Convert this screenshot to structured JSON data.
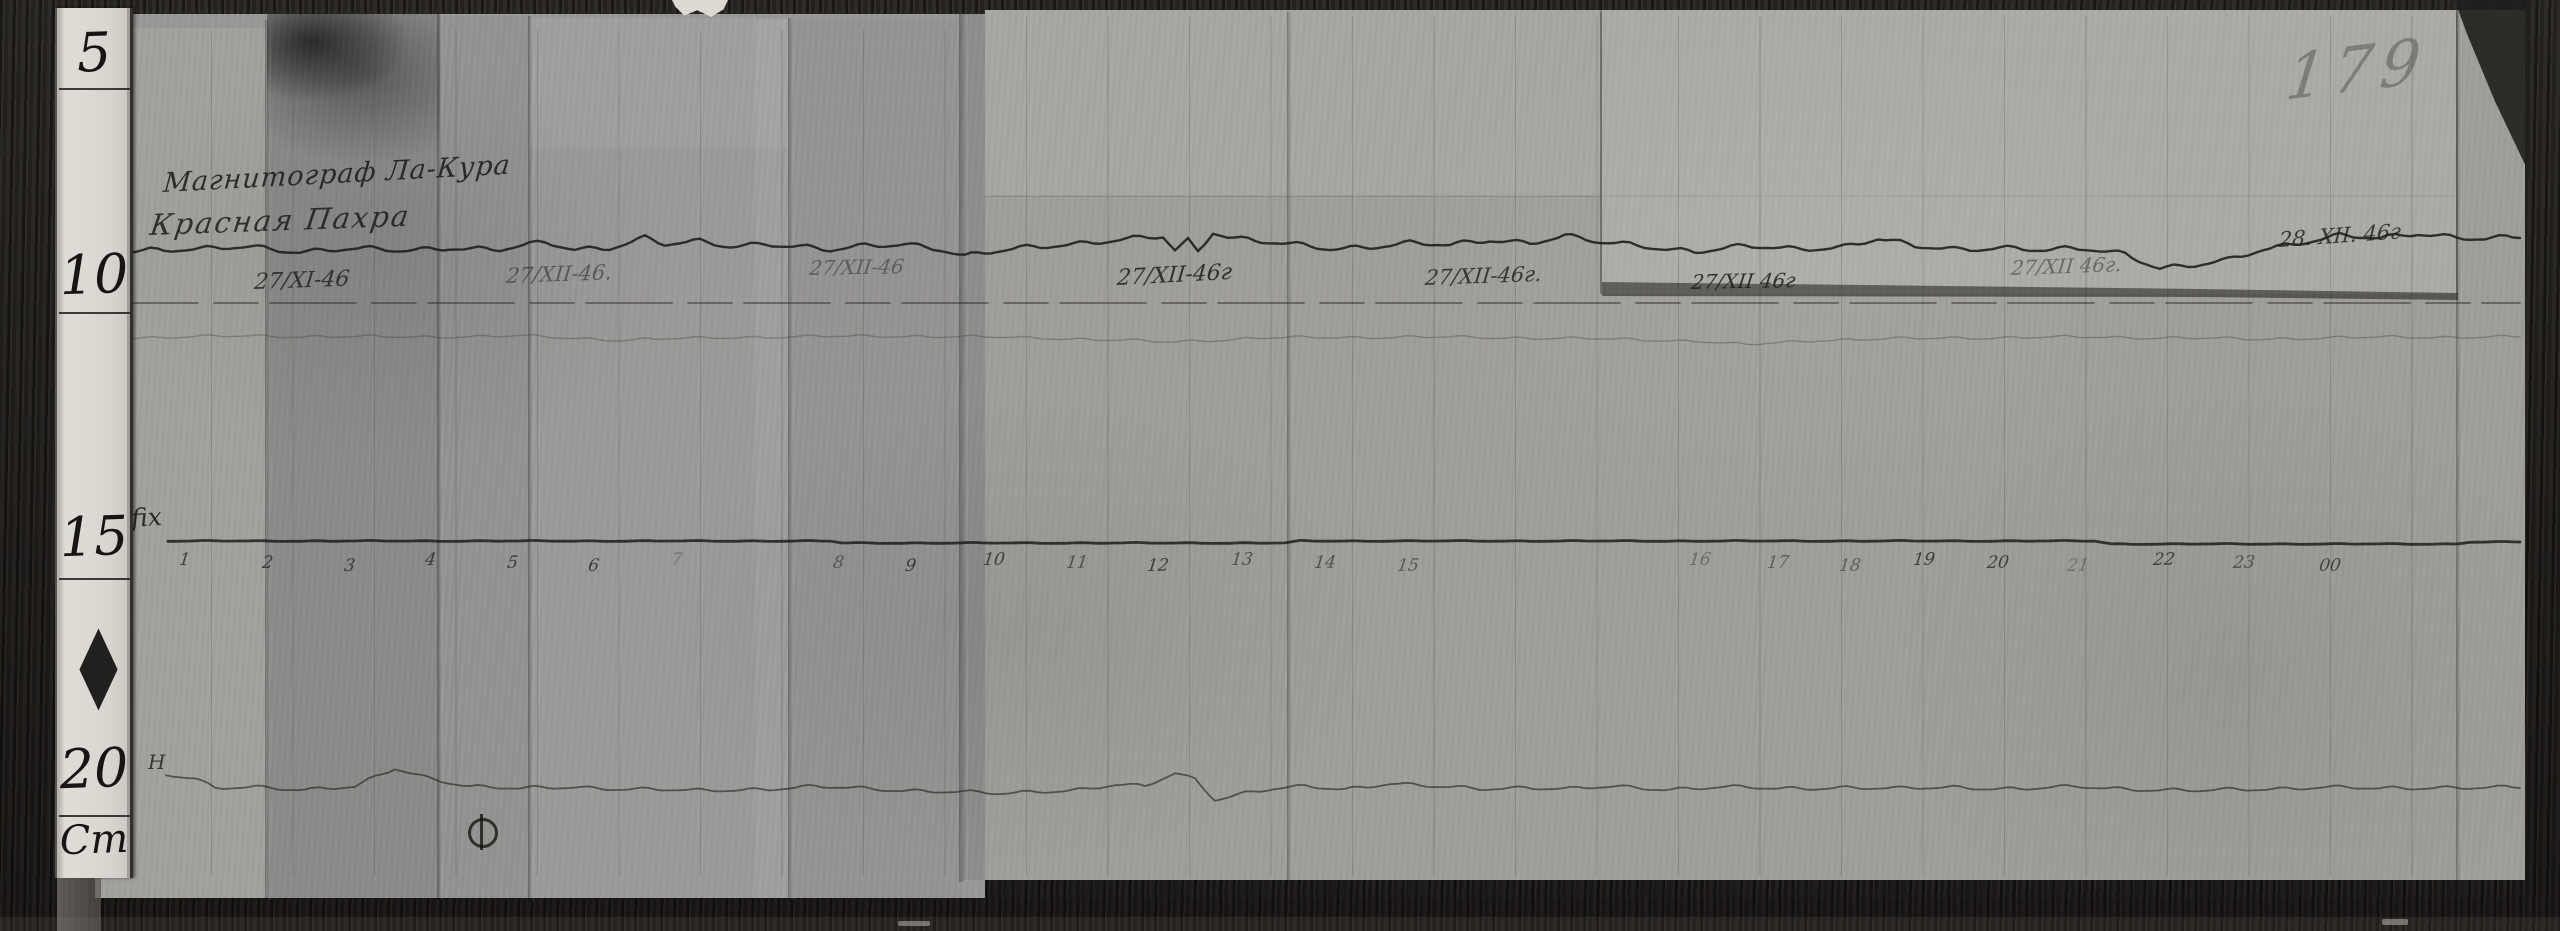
{
  "photo": {
    "page_number": "179",
    "header": {
      "instrument": "Магнитограф Ла-Кура",
      "station": "Красная Пахра"
    },
    "trace_labels": {
      "declination": "D",
      "baseline": "fix",
      "horizontal": "H"
    },
    "ruler": {
      "marks": [
        "5",
        "10",
        "15",
        "20"
      ],
      "unit_label": "Cm"
    },
    "dates": [
      {
        "text": "27/XI-46",
        "x": 253,
        "y": 270,
        "size": 22,
        "opacity": 0.8,
        "rotate": -2
      },
      {
        "text": "27/XII-46.",
        "x": 505,
        "y": 264,
        "size": 21,
        "opacity": 0.5,
        "rotate": -2
      },
      {
        "text": "27/XII-46",
        "x": 808,
        "y": 256,
        "size": 20,
        "opacity": 0.45,
        "rotate": -1
      },
      {
        "text": "27/XII-46г",
        "x": 1116,
        "y": 266,
        "size": 22,
        "opacity": 0.85,
        "rotate": -3
      },
      {
        "text": "27/XII-46г.",
        "x": 1424,
        "y": 266,
        "size": 21,
        "opacity": 0.8,
        "rotate": -2
      },
      {
        "text": "27/XII 46г",
        "x": 1690,
        "y": 270,
        "size": 20,
        "opacity": 0.85,
        "rotate": -1
      },
      {
        "text": "27/XII 46г.",
        "x": 2010,
        "y": 256,
        "size": 20,
        "opacity": 0.45,
        "rotate": -2
      },
      {
        "text": "28. XII. 46г",
        "x": 2278,
        "y": 228,
        "size": 21,
        "opacity": 0.8,
        "rotate": -4
      }
    ],
    "hours": [
      {
        "label": "1",
        "x": 178
      },
      {
        "label": "2",
        "x": 261
      },
      {
        "label": "3",
        "x": 343
      },
      {
        "label": "4",
        "x": 424
      },
      {
        "label": "5",
        "x": 506
      },
      {
        "label": "6",
        "x": 587
      },
      {
        "label": "7",
        "x": 670,
        "opacity": 0.3
      },
      {
        "label": "8",
        "x": 832,
        "opacity": 0.55
      },
      {
        "label": "9",
        "x": 904
      },
      {
        "label": "10",
        "x": 982
      },
      {
        "label": "11",
        "x": 1065,
        "opacity": 0.6
      },
      {
        "label": "12",
        "x": 1146
      },
      {
        "label": "13",
        "x": 1230,
        "opacity": 0.6
      },
      {
        "label": "14",
        "x": 1313,
        "opacity": 0.6
      },
      {
        "label": "15",
        "x": 1396,
        "opacity": 0.55
      },
      {
        "label": "16",
        "x": 1688,
        "opacity": 0.4
      },
      {
        "label": "17",
        "x": 1766,
        "opacity": 0.5
      },
      {
        "label": "18",
        "x": 1838,
        "opacity": 0.5
      },
      {
        "label": "19",
        "x": 1912
      },
      {
        "label": "20",
        "x": 1986
      },
      {
        "label": "21",
        "x": 2066,
        "opacity": 0.35
      },
      {
        "label": "22",
        "x": 2152
      },
      {
        "label": "23",
        "x": 2232,
        "opacity": 0.6
      },
      {
        "label": "00",
        "x": 2318,
        "opacity": 0.7
      }
    ]
  },
  "chart_data": {
    "type": "line",
    "title": "Магнитограф Ла-Кура — Красная Пахра",
    "subtitle_dates": [
      "27/XI-46",
      "27/XII-46.",
      "27/XII-46",
      "27/XII-46г",
      "27/XII-46г.",
      "27/XII 46г",
      "27/XII 46г.",
      "28. XII. 46г"
    ],
    "xlabel": "hours (1–23, 00)",
    "x_ticks": [
      "1",
      "2",
      "3",
      "4",
      "5",
      "6",
      "7",
      "8",
      "9",
      "10",
      "11",
      "12",
      "13",
      "14",
      "15",
      "16",
      "17",
      "18",
      "19",
      "20",
      "21",
      "22",
      "23",
      "00"
    ],
    "ylabel": "",
    "legend": [
      "D (declination trace)",
      "straight reference line",
      "secondary faint trace",
      "fix (time baseline)",
      "H (horizontal-intensity trace)"
    ],
    "note": "Photographic magnetogram; no printed vertical scale. Points are [x_px, y_px] anchors of the traces in image coordinates.",
    "series": [
      {
        "name": "D",
        "points": [
          [
            112,
            252
          ],
          [
            150,
            249
          ],
          [
            200,
            250
          ],
          [
            250,
            247
          ],
          [
            300,
            251
          ],
          [
            350,
            249
          ],
          [
            400,
            251
          ],
          [
            450,
            247
          ],
          [
            500,
            250
          ],
          [
            545,
            243
          ],
          [
            575,
            249
          ],
          [
            610,
            247
          ],
          [
            645,
            238
          ],
          [
            665,
            245
          ],
          [
            700,
            242
          ],
          [
            730,
            246
          ],
          [
            765,
            243
          ],
          [
            800,
            247
          ],
          [
            830,
            251
          ],
          [
            865,
            246
          ],
          [
            905,
            243
          ],
          [
            940,
            249
          ],
          [
            965,
            257
          ],
          [
            990,
            253
          ],
          [
            1020,
            248
          ],
          [
            1060,
            244
          ],
          [
            1100,
            242
          ],
          [
            1140,
            239
          ],
          [
            1163,
            237
          ],
          [
            1175,
            250
          ],
          [
            1188,
            240
          ],
          [
            1198,
            251
          ],
          [
            1213,
            231
          ],
          [
            1228,
            236
          ],
          [
            1255,
            241
          ],
          [
            1290,
            245
          ],
          [
            1330,
            249
          ],
          [
            1370,
            246
          ],
          [
            1410,
            243
          ],
          [
            1450,
            246
          ],
          [
            1490,
            240
          ],
          [
            1530,
            242
          ],
          [
            1565,
            236
          ],
          [
            1600,
            243
          ],
          [
            1645,
            246
          ],
          [
            1695,
            251
          ],
          [
            1745,
            247
          ],
          [
            1795,
            249
          ],
          [
            1845,
            246
          ],
          [
            1878,
            239
          ],
          [
            1915,
            247
          ],
          [
            1955,
            249
          ],
          [
            2000,
            247
          ],
          [
            2045,
            251
          ],
          [
            2085,
            249
          ],
          [
            2125,
            253
          ],
          [
            2160,
            268
          ],
          [
            2195,
            266
          ],
          [
            2228,
            261
          ],
          [
            2262,
            249
          ],
          [
            2300,
            242
          ],
          [
            2340,
            236
          ],
          [
            2380,
            239
          ],
          [
            2418,
            233
          ],
          [
            2450,
            236
          ],
          [
            2485,
            239
          ],
          [
            2520,
            238
          ]
        ]
      },
      {
        "name": "baseline-straight",
        "points": [
          [
            112,
            303
          ],
          [
            2520,
            303
          ]
        ]
      },
      {
        "name": "secondary-faint",
        "points": [
          [
            112,
            338
          ],
          [
            250,
            336
          ],
          [
            400,
            337
          ],
          [
            520,
            336
          ],
          [
            620,
            340
          ],
          [
            750,
            337
          ],
          [
            900,
            336
          ],
          [
            1050,
            338
          ],
          [
            1170,
            342
          ],
          [
            1260,
            338
          ],
          [
            1400,
            337
          ],
          [
            1550,
            338
          ],
          [
            1700,
            341
          ],
          [
            1745,
            345
          ],
          [
            1820,
            340
          ],
          [
            1950,
            338
          ],
          [
            2100,
            337
          ],
          [
            2250,
            339
          ],
          [
            2400,
            337
          ],
          [
            2520,
            337
          ]
        ]
      },
      {
        "name": "fix-baseline",
        "points": [
          [
            168,
            541
          ],
          [
            830,
            541
          ],
          [
            842,
            543
          ],
          [
            1285,
            543
          ],
          [
            1300,
            541
          ],
          [
            2095,
            541
          ],
          [
            2112,
            544
          ],
          [
            2455,
            544
          ],
          [
            2470,
            542
          ],
          [
            2520,
            542
          ]
        ]
      },
      {
        "name": "H",
        "points": [
          [
            166,
            774
          ],
          [
            195,
            779
          ],
          [
            215,
            789
          ],
          [
            255,
            787
          ],
          [
            305,
            789
          ],
          [
            355,
            787
          ],
          [
            395,
            769
          ],
          [
            425,
            777
          ],
          [
            470,
            786
          ],
          [
            520,
            789
          ],
          [
            575,
            787
          ],
          [
            635,
            789
          ],
          [
            695,
            791
          ],
          [
            755,
            789
          ],
          [
            815,
            787
          ],
          [
            875,
            789
          ],
          [
            935,
            791
          ],
          [
            1000,
            794
          ],
          [
            1045,
            791
          ],
          [
            1085,
            789
          ],
          [
            1115,
            785
          ],
          [
            1145,
            787
          ],
          [
            1175,
            773
          ],
          [
            1195,
            779
          ],
          [
            1215,
            799
          ],
          [
            1245,
            793
          ],
          [
            1275,
            789
          ],
          [
            1305,
            787
          ],
          [
            1345,
            789
          ],
          [
            1390,
            783
          ],
          [
            1435,
            787
          ],
          [
            1480,
            789
          ],
          [
            1525,
            787
          ],
          [
            1570,
            789
          ],
          [
            1615,
            787
          ],
          [
            1665,
            789
          ],
          [
            1720,
            787
          ],
          [
            1780,
            789
          ],
          [
            1840,
            787
          ],
          [
            1900,
            789
          ],
          [
            1960,
            787
          ],
          [
            2020,
            789
          ],
          [
            2080,
            787
          ],
          [
            2140,
            789
          ],
          [
            2200,
            791
          ],
          [
            2260,
            789
          ],
          [
            2320,
            787
          ],
          [
            2380,
            789
          ],
          [
            2440,
            787
          ],
          [
            2520,
            788
          ]
        ]
      }
    ]
  }
}
